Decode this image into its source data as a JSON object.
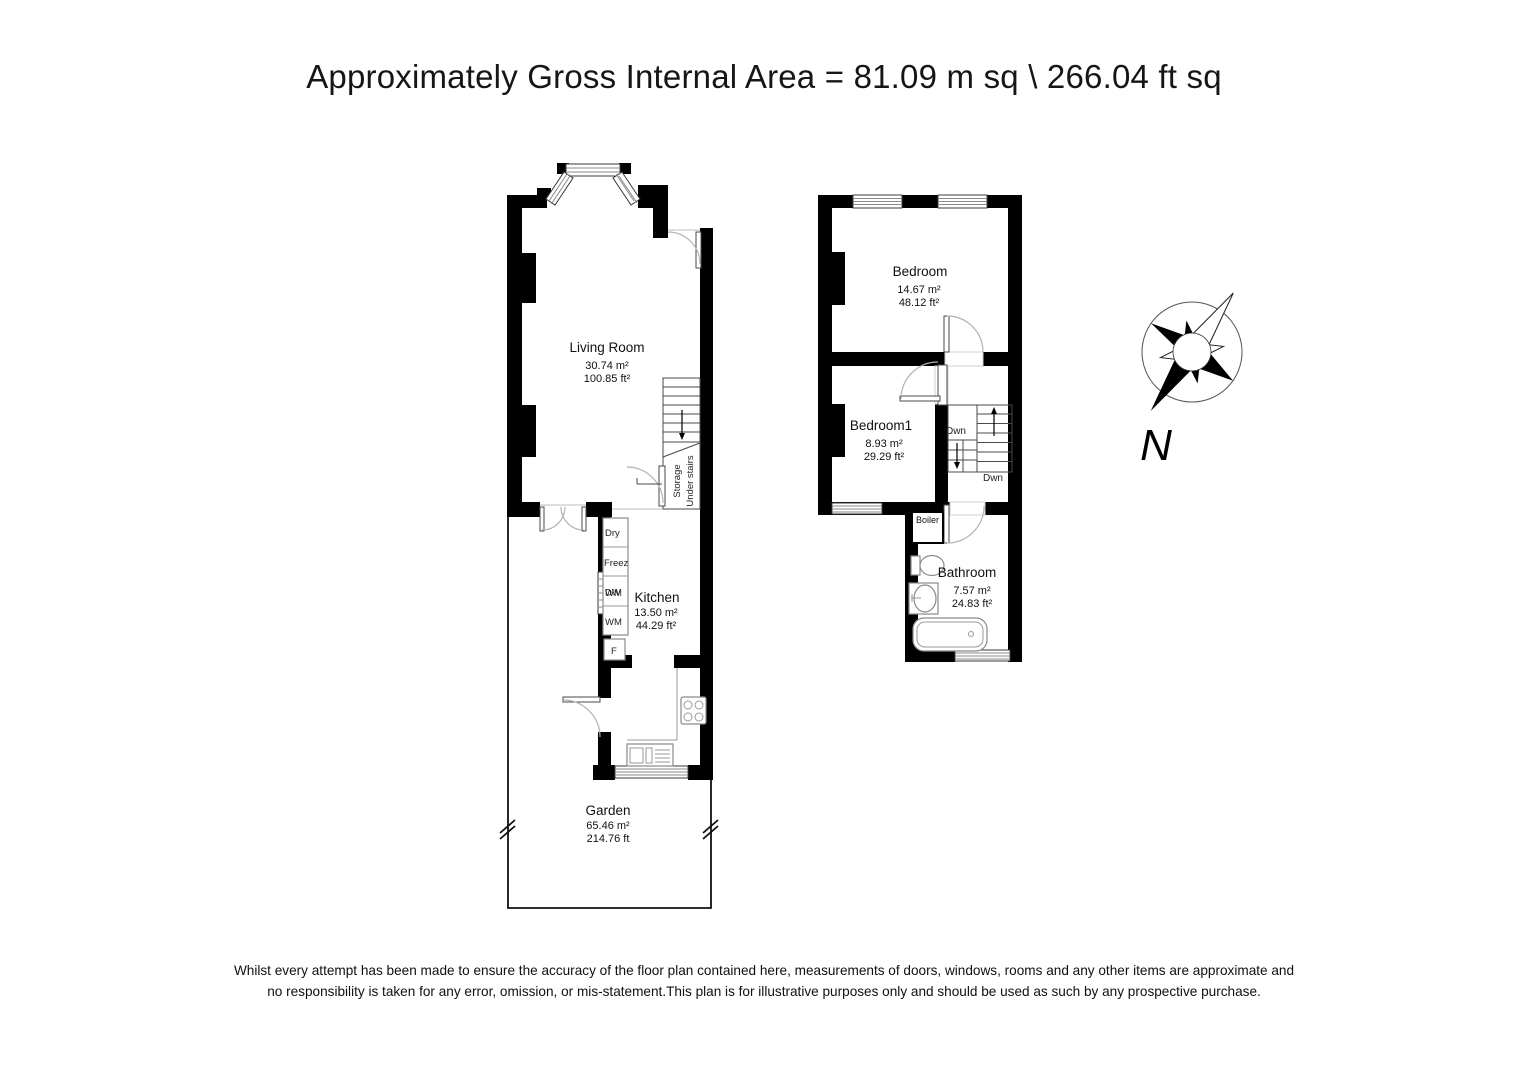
{
  "title": "Approximately Gross Internal Area = 81.09 m sq \\ 266.04 ft sq",
  "ground_floor": {
    "living_room": {
      "name": "Living Room",
      "area_m": "30.74 m²",
      "area_ft": "100.85 ft²"
    },
    "kitchen": {
      "name": "Kitchen",
      "area_m": "13.50 m²",
      "area_ft": "44.29 ft²"
    },
    "garden": {
      "name": "Garden",
      "area_m": "65.46 m²",
      "area_ft": "214.76 ft"
    },
    "understairs_storage": {
      "line1": "Under stairs",
      "line2": "Storage"
    },
    "appliances": {
      "dryer": "Dry",
      "freezer": "Freez",
      "dishwasher": "DW",
      "washing_machine": "WM",
      "fridge": "F"
    }
  },
  "first_floor": {
    "bedroom": {
      "name": "Bedroom",
      "area_m": "14.67 m²",
      "area_ft": "48.12 ft²"
    },
    "bedroom1": {
      "name": "Bedroom1",
      "area_m": "8.93 m²",
      "area_ft": "29.29 ft²"
    },
    "bathroom": {
      "name": "Bathroom",
      "area_m": "7.57 m²",
      "area_ft": "24.83 ft²"
    },
    "boiler_label": "Boiler",
    "stairs": {
      "down_label_upper": "Dwn",
      "down_label_lower": "Dwn"
    }
  },
  "compass": {
    "north_label": "N"
  },
  "disclaimer": {
    "line1": "Whilst every attempt has been made to ensure the accuracy of the floor plan contained here, measurements of doors, windows, rooms and any other items are approximate and",
    "line2": "no responsibility is taken for any error, omission, or mis-statement.This plan is for illustrative purposes only and should be used as such by any prospective purchase."
  },
  "colors": {
    "wall": "#000000",
    "thin_line": "#9b9b9b",
    "text": "#1a1a1a"
  }
}
